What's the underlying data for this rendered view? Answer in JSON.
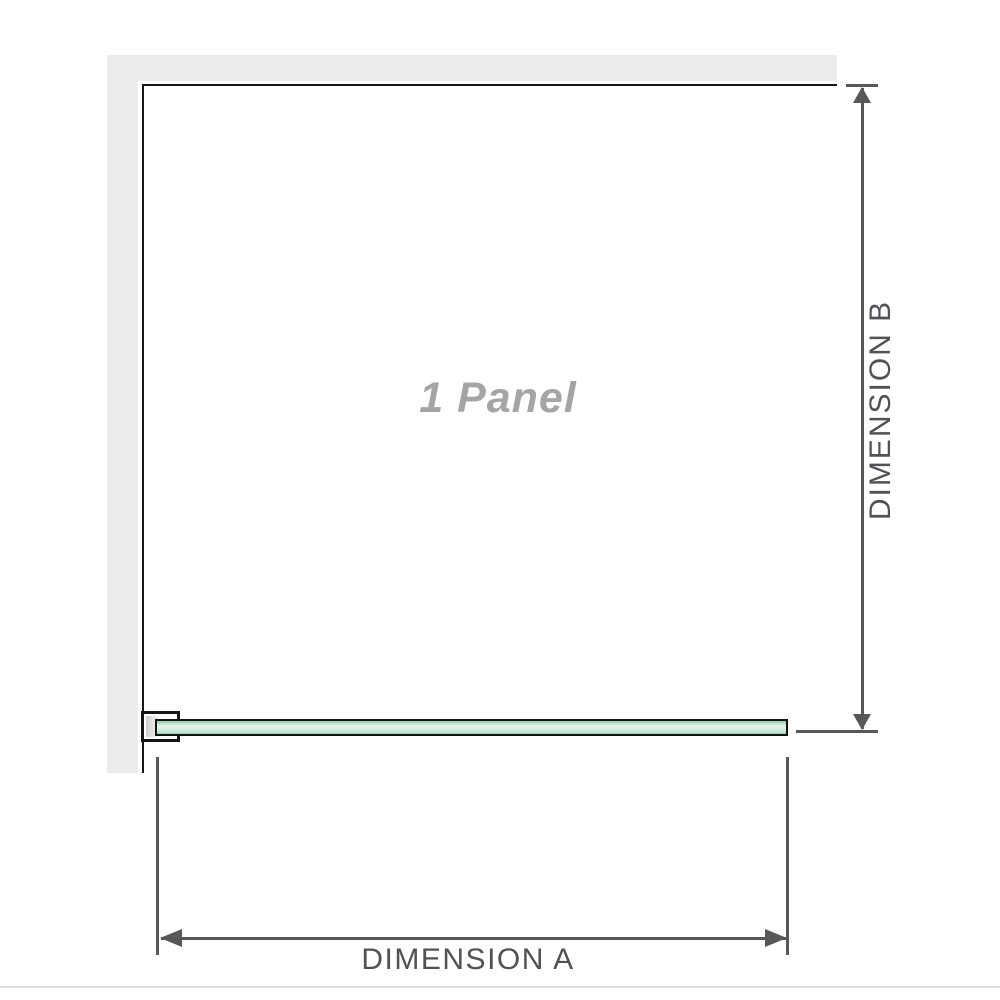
{
  "diagram": {
    "panel_label": "1 Panel",
    "dimensions": {
      "a_label": "DIMENSION A",
      "b_label": "DIMENSION B"
    },
    "colors": {
      "background": "#ffffff",
      "wall": "#ececec",
      "panel_border": "#161616",
      "glass_green_dark": "#93d2ae",
      "glass_green_light": "#ebf7f0",
      "dimension_line": "#58585a",
      "dimension_text": "#515256",
      "panel_label_text": "#a5a5a5",
      "divider": "#dedede"
    }
  }
}
